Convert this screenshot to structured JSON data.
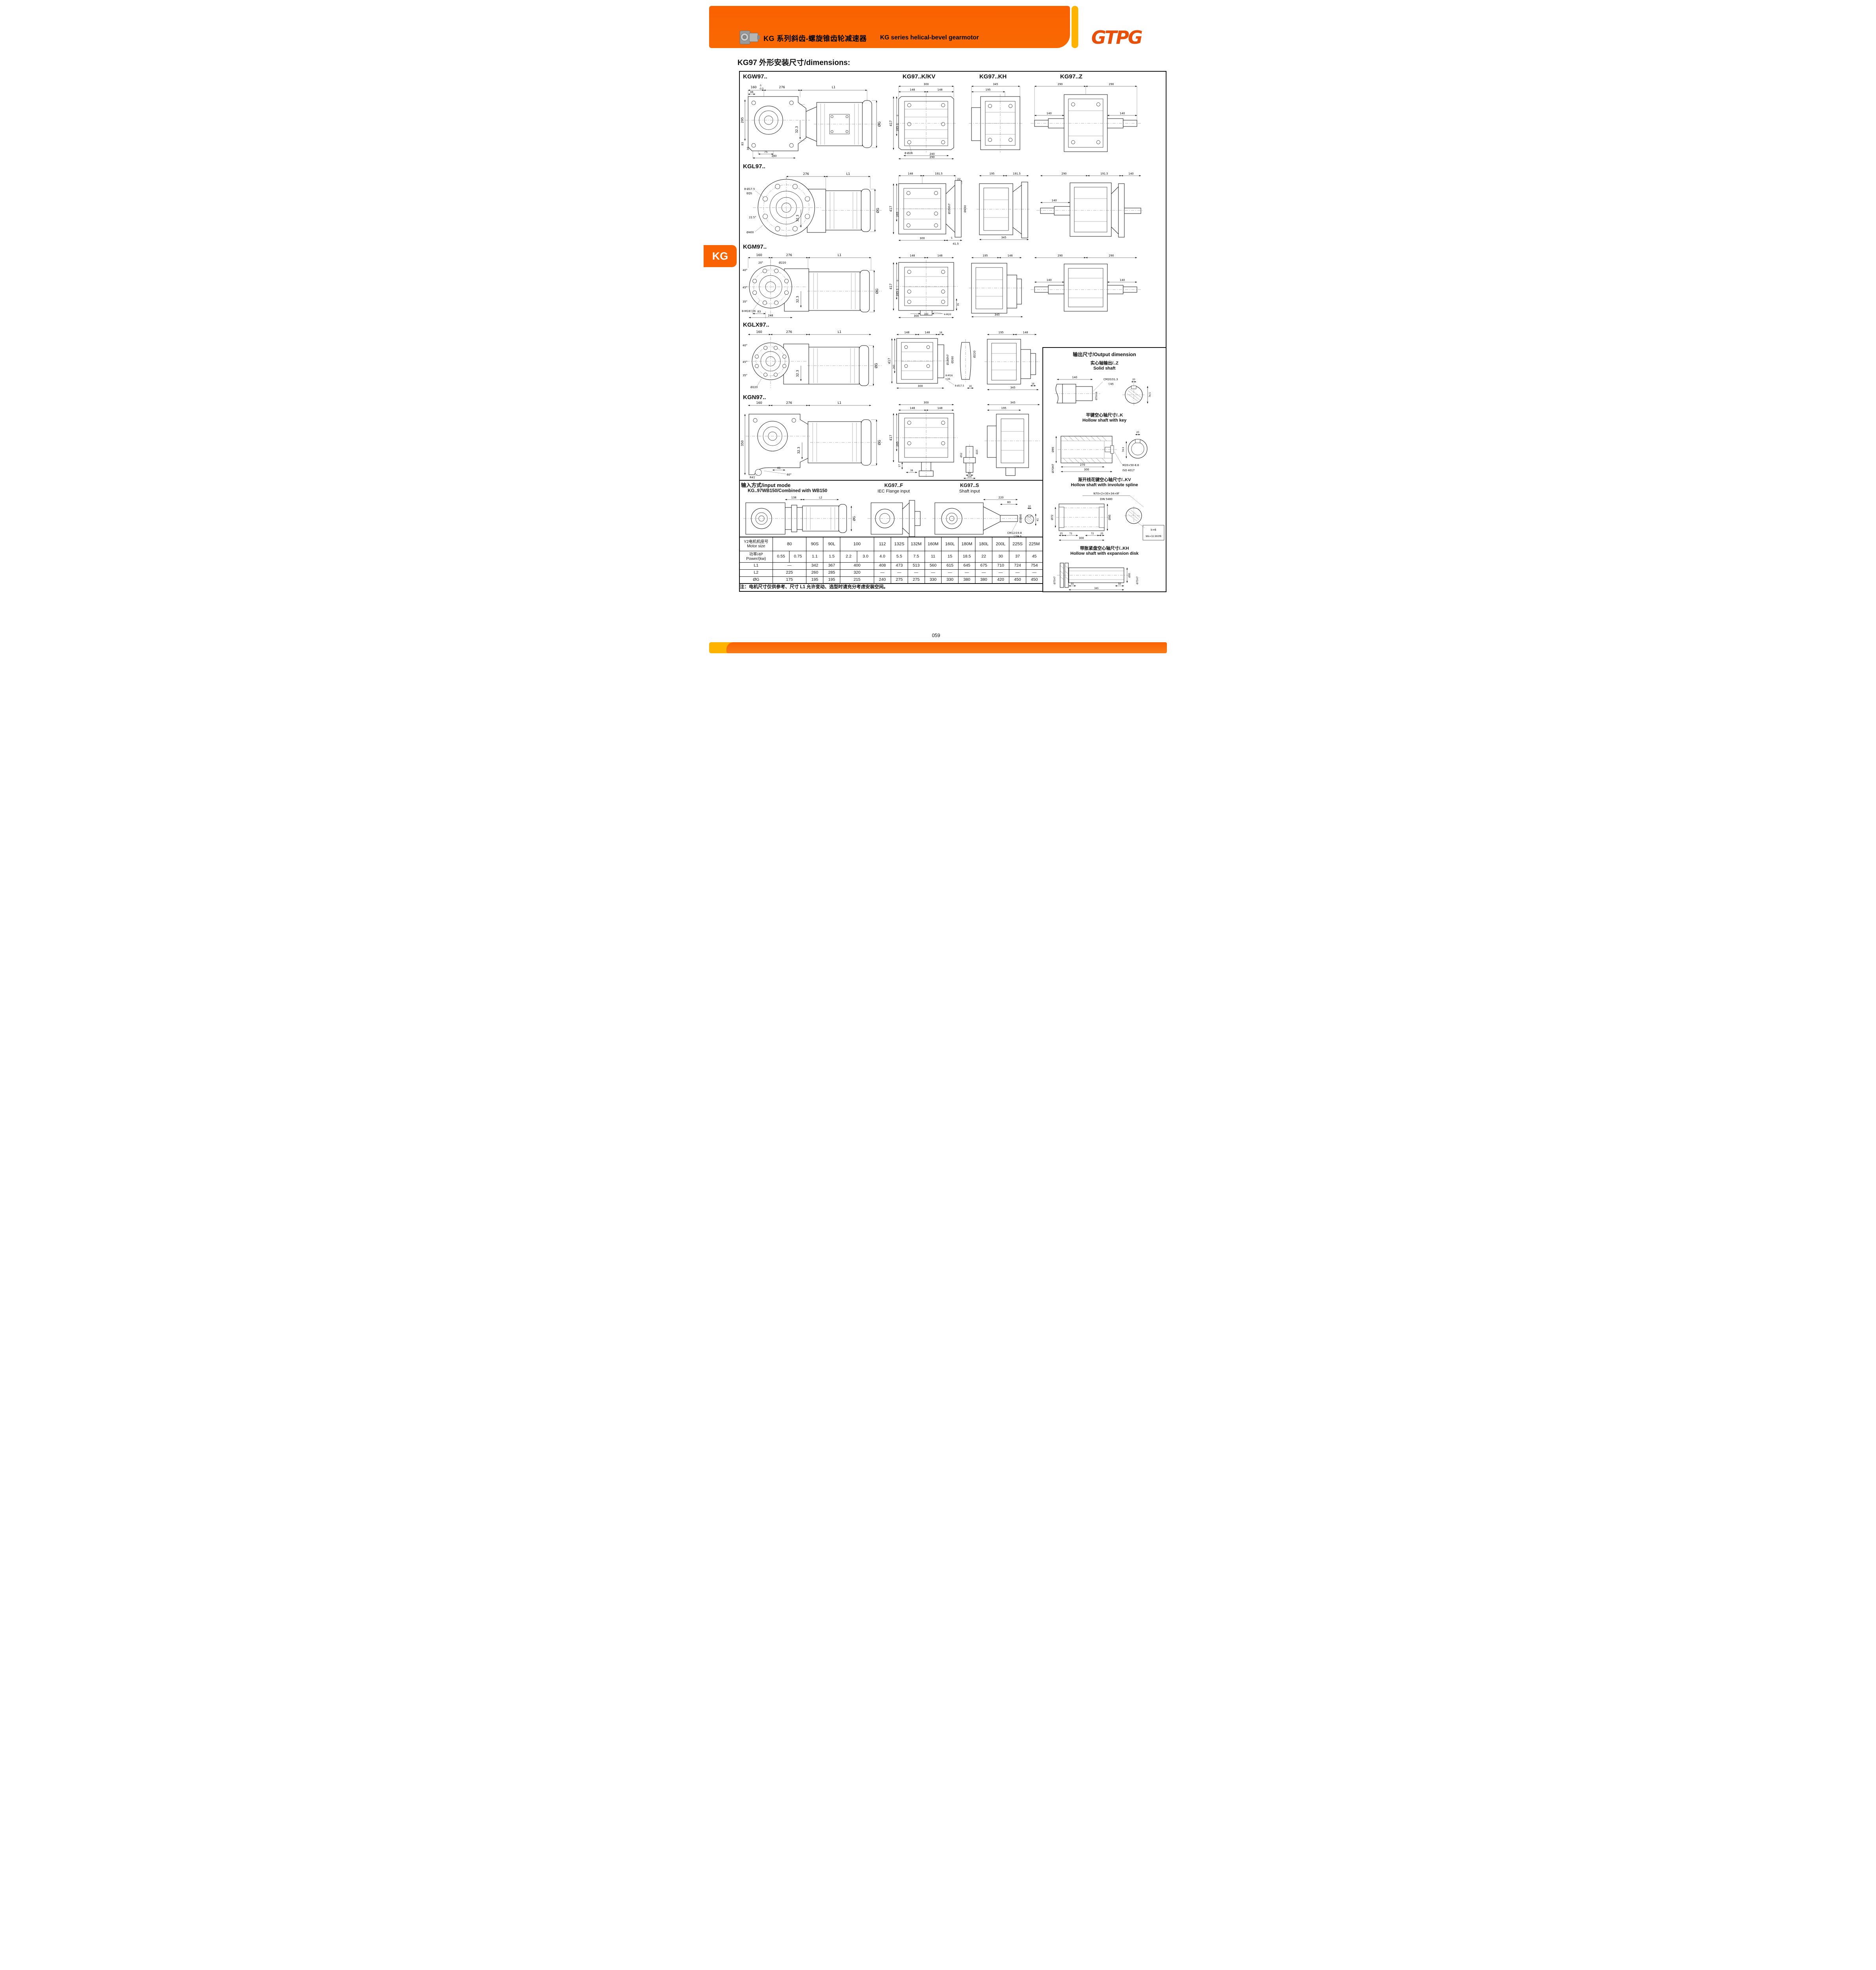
{
  "header": {
    "zh": "KG 系列斜齿-螺旋锥齿轮减速器",
    "en": "KG series helical-bevel gearmotor",
    "logo": "GTPG",
    "tab": "KG"
  },
  "page": {
    "title": "KG97 外形安装尺寸/dimensions:",
    "number": "059",
    "note": "注：电机尺寸仅供参考、尺寸 L1 允许变动、选型时请充分考虑安装空间。"
  },
  "cols": [
    "KG97..K/KV",
    "KG97..KH",
    "KG97..Z"
  ],
  "d": {
    "r1": {
      "name": "KGW97..",
      "front": [
        "160",
        "0",
        "-0.5",
        "276",
        "L1",
        "36",
        "295",
        "32.3",
        "83",
        "36",
        "75",
        "240",
        "ØG"
      ],
      "kv": [
        "300",
        "148",
        "148",
        "417",
        "265-1",
        "0",
        "8-Ø26",
        "240",
        "290"
      ],
      "kh": [
        "345",
        "195"
      ],
      "z": [
        "290",
        "290",
        "140",
        "140"
      ]
    },
    "r2": {
      "name": "KGL97..",
      "front": [
        "276",
        "L1",
        "8-Ø17.5",
        "EQS",
        "22.5°",
        "Ø400",
        "32.3",
        "ØG"
      ],
      "kv": [
        "148",
        "191.5",
        "22",
        "417",
        "265",
        "Ø350h7",
        "Ø450",
        "5",
        "300",
        "41.5"
      ],
      "kh": [
        "195",
        "191.5",
        "345"
      ],
      "z": [
        "290",
        "191.5",
        "140",
        "140"
      ]
    },
    "r3": {
      "name": "KGM97..",
      "front": [
        "160",
        "276",
        "L1",
        "20°",
        "Ø220",
        "40°",
        "45°",
        "35°",
        "8-M16▽26",
        "32.3",
        "83",
        "248",
        "ØG"
      ],
      "kv": [
        "148",
        "148",
        "417",
        "265-1",
        "0",
        "35",
        "160",
        "300",
        "4-M20"
      ],
      "kh": [
        "195",
        "148",
        "345"
      ],
      "z": [
        "290",
        "290",
        "140",
        "140"
      ]
    },
    "r4": {
      "name": "KGLX97..",
      "front": [
        "160",
        "276",
        "L1",
        "40°",
        "45°",
        "35°",
        "Ø220",
        "32.3",
        "ØG"
      ],
      "kv": [
        "148",
        "148",
        "18",
        "417",
        "265",
        "Ø180h7",
        "Ø260",
        "8-M16",
        "▽26",
        "8-Ø17.5",
        "Ø220",
        "300",
        "16"
      ],
      "kh": [
        "195",
        "148",
        "345",
        "16"
      ]
    },
    "r5": {
      "name": "KGN97..",
      "front": [
        "160",
        "276",
        "L1",
        "350",
        "32.3",
        "41",
        "60°",
        "R41",
        "ØG"
      ],
      "kv": [
        "300",
        "148",
        "148",
        "417",
        "265",
        "17",
        "38",
        "Ø52",
        "92",
        "100",
        "Ø25"
      ],
      "kh": [
        "345",
        "195"
      ]
    }
  },
  "input": {
    "t": "输入方式/input mode",
    "sub": "KG..97WB150/Combined with WB150",
    "dims": [
      "138",
      "L2",
      "ØG"
    ]
  },
  "fd": {
    "t": "KG97..F",
    "sub": "IEC Flange input"
  },
  "sd": {
    "t": "KG97..S",
    "sub": "Shaft input",
    "dims": [
      "220",
      "80",
      "Ø38k6",
      "10",
      "41",
      "CM12/19.8",
      "▽29.5"
    ]
  },
  "panel": {
    "title": "输出尺寸/Output dimension",
    "z": {
      "t1": "实心轴输出/..Z",
      "t2": "Solid shaft",
      "dims": [
        "140",
        "CM20/31.3",
        "▽45",
        "20",
        "Ø70m6",
        "74.5"
      ]
    },
    "k": {
      "t1": "平键空心轴尺寸/..K",
      "t2": "Hollow shaft with key",
      "dims": [
        "Ø95",
        "Ø70H7",
        "270",
        "300",
        "M20×50-8.8",
        "ISO 4017",
        "20",
        "74.9"
      ]
    },
    "kv": {
      "t1": "渐开线花键空心轴尺寸/..KV",
      "t2": "Hollow shaft with involute spline",
      "dims": [
        "N70×2×30×34×8f",
        "DIN 5480",
        "Ø72",
        "Ø95",
        "25",
        "72",
        "72",
        "25",
        "300",
        "k=6",
        "Wk=32.993f8"
      ]
    },
    "kh": {
      "t1": "带胀紧盘空心轴尺寸/..KH",
      "t2": "Hollow shaft with expansion disk",
      "dims": [
        "Ø75H7",
        "55",
        "345",
        "50",
        "Ø95",
        "Ø75H7"
      ]
    }
  },
  "table": {
    "motor_zh": "Y2电机机座号",
    "motor_en": "Motor size",
    "power_zh": "功率/4P",
    "power_en": "Power/(kw)",
    "l1": "L1",
    "l2": "L2",
    "g": "ØG",
    "sizes": [
      "80",
      "90S",
      "90L",
      "100",
      "112",
      "132S",
      "132M",
      "160M",
      "160L",
      "180M",
      "180L",
      "200L",
      "225S",
      "225M"
    ],
    "power": [
      "0.55",
      "0.75",
      "1.1",
      "1.5",
      "2.2",
      "3.0",
      "4.0",
      "5.5",
      "7.5",
      "11",
      "15",
      "18.5",
      "22",
      "30",
      "37",
      "45"
    ],
    "L1": [
      "—",
      "342",
      "367",
      "400",
      "408",
      "473",
      "513",
      "560",
      "615",
      "645",
      "675",
      "710",
      "724",
      "754"
    ],
    "L2": [
      "225",
      "260",
      "285",
      "320",
      "—",
      "—",
      "—",
      "—",
      "—",
      "—",
      "—",
      "—",
      "—",
      "—"
    ],
    "G": [
      "175",
      "195",
      "195",
      "215",
      "240",
      "275",
      "275",
      "330",
      "330",
      "380",
      "380",
      "420",
      "450",
      "450"
    ]
  }
}
